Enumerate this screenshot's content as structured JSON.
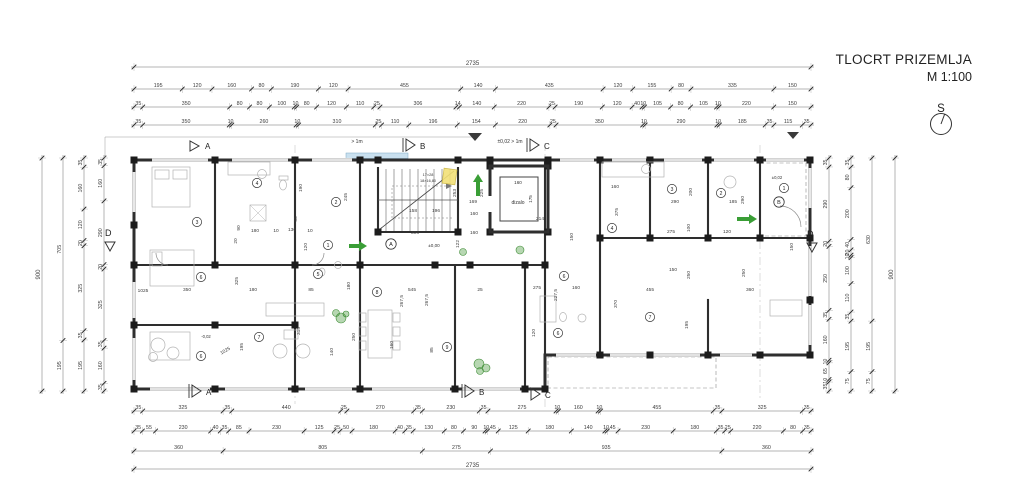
{
  "title": {
    "name": "TLOCRT PRIZEMLJA",
    "scale": "M 1:100"
  },
  "compass": {
    "label": "S"
  },
  "colors": {
    "wall": "#2e2e2e",
    "dim_line": "#6a6a6a",
    "dim_text": "#3c3c3c",
    "accent_green": "#3a9e36",
    "highlight_yellow": "#f2e077",
    "glazing_blue": "#c9e0ef",
    "furniture": "#b3b3b3"
  },
  "dims": {
    "top": [
      [
        "2735"
      ],
      [
        "195",
        "120",
        "160",
        "80",
        "190",
        "120",
        "455",
        "140",
        "435",
        "120",
        "155",
        "80",
        "335",
        "150"
      ],
      [
        "35",
        "350",
        "80",
        "80",
        "100",
        "10",
        "80",
        "120",
        "110",
        "25",
        "306",
        "14",
        "140",
        "220",
        "25",
        "190",
        "120",
        "40",
        "10",
        "105",
        "80",
        "105",
        "10",
        "220",
        "150"
      ],
      [
        "35",
        "350",
        "10",
        "260",
        "10",
        "310",
        "25",
        "110",
        "196",
        "154",
        "220",
        "25",
        "350",
        "10",
        "290",
        "10",
        "185",
        "35",
        "115",
        "35"
      ]
    ],
    "bottom": [
      [
        "35",
        "325",
        "35",
        "440",
        "25",
        "270",
        "35",
        "230",
        "35",
        "275",
        "10",
        "160",
        "10",
        "455",
        "35",
        "325",
        "35"
      ],
      [
        "35",
        "55",
        "230",
        "40",
        "35",
        "85",
        "230",
        "125",
        "25",
        "50",
        "180",
        "40",
        "35",
        "130",
        "80",
        "90",
        "10",
        "45",
        "125",
        "180",
        "140",
        "10",
        "45",
        "230",
        "180",
        "35",
        "25",
        "220",
        "80",
        "35"
      ],
      [
        "360",
        "805",
        "275",
        "935",
        "360"
      ],
      [
        "2735"
      ]
    ],
    "left": [
      [
        "900"
      ],
      [
        "705",
        "195"
      ],
      [
        "35",
        "160",
        "120",
        "20",
        "325",
        "35",
        "195"
      ],
      [
        "35",
        "160",
        "290",
        "20",
        "325",
        "35",
        "160",
        "35"
      ]
    ],
    "right": [
      [
        "35",
        "290",
        "20",
        "250",
        "35",
        "160",
        "10",
        "65",
        "10",
        "35"
      ],
      [
        "35",
        "80",
        "200",
        "40",
        "20",
        "10",
        "100",
        "110",
        "35",
        "195",
        "75"
      ],
      [
        "630",
        "195",
        "75"
      ],
      [
        "900"
      ]
    ]
  },
  "plan": {
    "labels": [
      [
        "dizalo",
        518,
        204,
        5,
        0
      ],
      [
        "160",
        518,
        184,
        4.6,
        0
      ],
      [
        "175",
        532,
        199,
        4.6,
        -90
      ],
      [
        "17×28",
        428,
        176,
        3.8,
        0
      ],
      [
        "18×16,80",
        428,
        182,
        3.8,
        0
      ],
      [
        "±0,00",
        434,
        247,
        4.6,
        0
      ],
      [
        "±0,02",
        777,
        179,
        4.2,
        0
      ],
      [
        "-0,02",
        206,
        338,
        4.2,
        0
      ],
      [
        "> 1m",
        357,
        143,
        5,
        0
      ],
      [
        "±0,02 > 1m",
        510,
        143,
        5,
        0
      ]
    ],
    "inner_dims": [
      [
        "90",
        240,
        228,
        -90
      ],
      [
        "180",
        255,
        232,
        0
      ],
      [
        "130",
        292,
        231,
        0
      ],
      [
        "10",
        276,
        232,
        0
      ],
      [
        "10",
        310,
        232,
        0
      ],
      [
        "20",
        237,
        241,
        -90
      ],
      [
        "120",
        307,
        247,
        -90
      ],
      [
        "55",
        297,
        219,
        -90
      ],
      [
        "190",
        302,
        188,
        -90
      ],
      [
        "245",
        347,
        197,
        -90
      ],
      [
        "325",
        238,
        281,
        -90
      ],
      [
        "350",
        187,
        291,
        0
      ],
      [
        "180",
        253,
        291,
        0
      ],
      [
        "85",
        311,
        291,
        0
      ],
      [
        "315",
        300,
        331,
        -90
      ],
      [
        "140",
        333,
        352,
        -90
      ],
      [
        "250",
        355,
        337,
        -90
      ],
      [
        "180",
        350,
        286,
        -90
      ],
      [
        "195",
        243,
        347,
        -90
      ],
      [
        "1025",
        226,
        352,
        -30
      ],
      [
        "1025",
        143,
        292,
        0
      ],
      [
        "306",
        415,
        234,
        0
      ],
      [
        "158",
        413,
        212,
        0
      ],
      [
        "196",
        436,
        212,
        0
      ],
      [
        "253",
        456,
        193,
        -90
      ],
      [
        "225",
        483,
        193,
        -90
      ],
      [
        "169",
        473,
        203,
        0
      ],
      [
        "160",
        474,
        215,
        0
      ],
      [
        "160",
        474,
        234,
        0
      ],
      [
        "122",
        459,
        244,
        -90
      ],
      [
        "150",
        573,
        237,
        -90
      ],
      [
        "214",
        540,
        220,
        0
      ],
      [
        "545",
        412,
        291,
        0
      ],
      [
        "267,5",
        403,
        301,
        -90
      ],
      [
        "267,5",
        428,
        300,
        -90
      ],
      [
        "160",
        393,
        345,
        -90
      ],
      [
        "85",
        433,
        350,
        -90
      ],
      [
        "25",
        480,
        291,
        0
      ],
      [
        "275",
        537,
        289,
        0
      ],
      [
        "227,5",
        557,
        295,
        -90
      ],
      [
        "160",
        576,
        289,
        0
      ],
      [
        "120",
        535,
        333,
        -90
      ],
      [
        "370",
        617,
        304,
        -90
      ],
      [
        "455",
        650,
        291,
        0
      ],
      [
        "195",
        688,
        325,
        -90
      ],
      [
        "160",
        615,
        188,
        0
      ],
      [
        "375",
        618,
        212,
        -90
      ],
      [
        "290",
        675,
        203,
        0
      ],
      [
        "200",
        692,
        192,
        -90
      ],
      [
        "185",
        733,
        203,
        0
      ],
      [
        "290",
        744,
        200,
        -90
      ],
      [
        "275",
        671,
        233,
        0
      ],
      [
        "100",
        690,
        228,
        -90
      ],
      [
        "120",
        727,
        233,
        0
      ],
      [
        "150",
        673,
        271,
        0
      ],
      [
        "250",
        690,
        275,
        -90
      ],
      [
        "250",
        745,
        273,
        -90
      ],
      [
        "360",
        750,
        291,
        0
      ],
      [
        "150",
        793,
        247,
        -90
      ]
    ],
    "rooms": [
      [
        "3",
        197,
        222
      ],
      [
        "4",
        257,
        183
      ],
      [
        "2",
        336,
        202
      ],
      [
        "1",
        328,
        245
      ],
      [
        "6",
        201,
        277
      ],
      [
        "5",
        318,
        274
      ],
      [
        "7",
        259,
        337
      ],
      [
        "6",
        201,
        356
      ],
      [
        "8",
        377,
        292
      ],
      [
        "9",
        447,
        347
      ],
      [
        "6",
        564,
        276
      ],
      [
        "6",
        558,
        333
      ],
      [
        "7",
        650,
        317
      ],
      [
        "4",
        612,
        228
      ],
      [
        "3",
        672,
        189
      ],
      [
        "2",
        721,
        193
      ],
      [
        "1",
        784,
        188
      ]
    ],
    "bubbles": [
      [
        "A",
        391,
        244
      ],
      [
        "B",
        779,
        202
      ]
    ],
    "sections": [
      {
        "t": "A",
        "pts": "190,141 190,151 199,146",
        "lx": 205,
        "ly": 149,
        "bar": null
      },
      {
        "t": "B",
        "pts": "406,139 406,151 415,145",
        "lx": 420,
        "ly": 149,
        "bar": [
          403,
          138,
          403,
          152
        ]
      },
      {
        "t": "C",
        "pts": "530,139 530,151 539,145",
        "lx": 544,
        "ly": 149,
        "bar": [
          527,
          138,
          527,
          152
        ]
      },
      {
        "t": "A",
        "pts": "192,385 192,397 201,391",
        "lx": 206,
        "ly": 395,
        "bar": [
          189,
          384,
          189,
          398
        ]
      },
      {
        "t": "B",
        "pts": "465,385 465,397 474,391",
        "lx": 479,
        "ly": 395,
        "bar": [
          462,
          384,
          462,
          398
        ]
      },
      {
        "t": "C",
        "pts": "531,388 531,400 540,394",
        "lx": 545,
        "ly": 398,
        "bar": null
      },
      {
        "t": "D",
        "pts": "105,242 115,242 110,251",
        "lx": 105,
        "ly": 236,
        "bar": null
      },
      {
        "t": "D",
        "pts": "807,243 817,243 812,252",
        "lx": 807,
        "ly": 237,
        "bar": null
      }
    ],
    "arrows": [
      {
        "dir": "up",
        "x": 478,
        "y": 174,
        "len": 22
      },
      {
        "dir": "right",
        "x": 367,
        "y": 246,
        "len": 18
      },
      {
        "dir": "right",
        "x": 757,
        "y": 219,
        "len": 20
      }
    ],
    "entry_markers": [
      {
        "points": "468,133 482,133 475,141"
      },
      {
        "points": "787,132 799,132 793,139"
      }
    ],
    "highlight": {
      "x": 443,
      "y": 169,
      "w": 13,
      "h": 15,
      "rot": 8
    },
    "glazing": [
      {
        "x": 346,
        "y": 153,
        "w": 62,
        "h": 5.5
      }
    ],
    "plants": [
      {
        "x": 341,
        "y": 318,
        "r": 5
      },
      {
        "x": 336,
        "y": 313,
        "r": 3.5
      },
      {
        "x": 346,
        "y": 314,
        "r": 3
      },
      {
        "x": 463,
        "y": 252,
        "r": 3.5
      },
      {
        "x": 520,
        "y": 250,
        "r": 4
      },
      {
        "x": 479,
        "y": 364,
        "r": 5
      },
      {
        "x": 486,
        "y": 368,
        "r": 4
      },
      {
        "x": 480,
        "y": 371,
        "r": 3.5
      }
    ]
  }
}
